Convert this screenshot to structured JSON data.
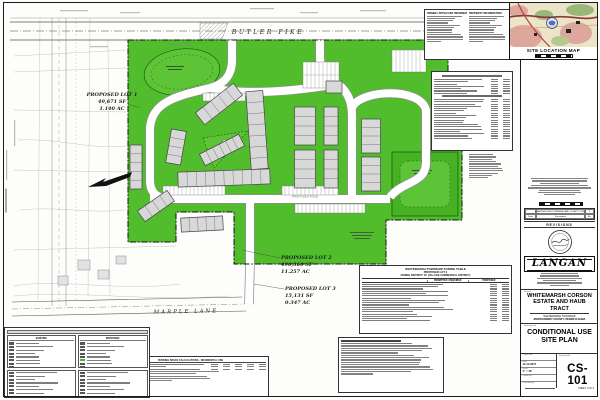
{
  "colors": {
    "open_space_green": "#52bd2c",
    "building_fill": "#d8d8d8",
    "road_white": "#ffffff"
  },
  "plan": {
    "streets": {
      "top": "BUTLER PIKE",
      "bottom": "MARPLE LANE"
    },
    "road_label": "PROPOSED ROAD",
    "lots": [
      {
        "name": "PROPOSED LOT 1",
        "area_sf": "49,671 SF",
        "area_ac": "1.140 AC"
      },
      {
        "name": "PROPOSED LOT 2",
        "area_sf": "490,360 SF",
        "area_ac": "11.257 AC"
      },
      {
        "name": "PROPOSED LOT 3",
        "area_sf": "15,131 SF",
        "area_ac": "0.347 AC"
      }
    ],
    "buildings": [
      [
        219,
        104,
        48,
        15,
        -38,
        5
      ],
      [
        176,
        147,
        34,
        15,
        -80,
        4
      ],
      [
        222,
        150,
        44,
        13,
        -27,
        6
      ],
      [
        257,
        130,
        78,
        17,
        86,
        7
      ],
      [
        224,
        178,
        92,
        15,
        -2,
        10
      ],
      [
        305,
        126,
        38,
        21,
        90,
        4
      ],
      [
        305,
        169,
        38,
        21,
        90,
        4
      ],
      [
        331,
        126,
        38,
        14,
        90,
        4
      ],
      [
        331,
        169,
        38,
        14,
        90,
        4
      ],
      [
        371,
        136,
        34,
        19,
        90,
        4
      ],
      [
        371,
        174,
        34,
        19,
        90,
        4
      ],
      [
        156,
        206,
        36,
        13,
        -35,
        4
      ],
      [
        202,
        224,
        42,
        14,
        -3,
        5
      ],
      [
        136,
        167,
        44,
        12,
        90,
        5
      ],
      [
        334,
        87,
        16,
        12,
        0,
        1
      ]
    ]
  },
  "owner_box": {
    "left_header": "OWNER / APPLICANT INFORMATION",
    "right_header": "PROPERTY INFORMATION"
  },
  "site_map": {
    "caption": "SITE LOCATION MAP"
  },
  "zoning_table": {
    "title": "WHITEMARSH TOWNSHIP ZONING TABLE",
    "subtitle": "PROPOSED LOT 2",
    "district": "ZONING DISTRICT: VC (VILLAGE COMMERCIAL DISTRICT)",
    "col_permitted": "PERMITTED / REQUIRED",
    "col_proposed": "PROPOSED"
  },
  "parking_table": {
    "title": "PARKING SPACE CALCULATIONS - RESIDENTIAL USE"
  },
  "legend": {
    "existing_header": "EXISTING",
    "proposed_header": "PROPOSED"
  },
  "title_block": {
    "firm": "LANGAN",
    "revisions_title": "REVISIONS",
    "rev_headers": {
      "date": "Date",
      "description": "Description",
      "no": "No."
    },
    "rev_entry": {
      "description": "REVISED PER TOWNSHIP AND COUNTY COMMENTS",
      "no": "1"
    },
    "project_label": "Project",
    "project_name": "WHITEMARSH CORSON ESTATE AND HAUB TRACT",
    "location_line1": "WHITEMARSH TOWNSHIP",
    "location_line2": "MONTGOMERY COUNTY, PENNSYLVANIA",
    "drawing_title_label": "Drawing Title",
    "drawing_title": "CONDITIONAL USE SITE PLAN",
    "fields": [
      {
        "label": "Project No.",
        "value": ""
      },
      {
        "label": "Date",
        "value": "12-14-2017"
      },
      {
        "label": "Scale",
        "value": "1\" = 40'"
      },
      {
        "label": "Drawn By",
        "value": ""
      },
      {
        "label": "Checked By",
        "value": ""
      }
    ],
    "drawing_no_label": "Drawing No.",
    "sheet_number": "CS-101",
    "sheet_of": "SHEET 1 OF 3"
  }
}
